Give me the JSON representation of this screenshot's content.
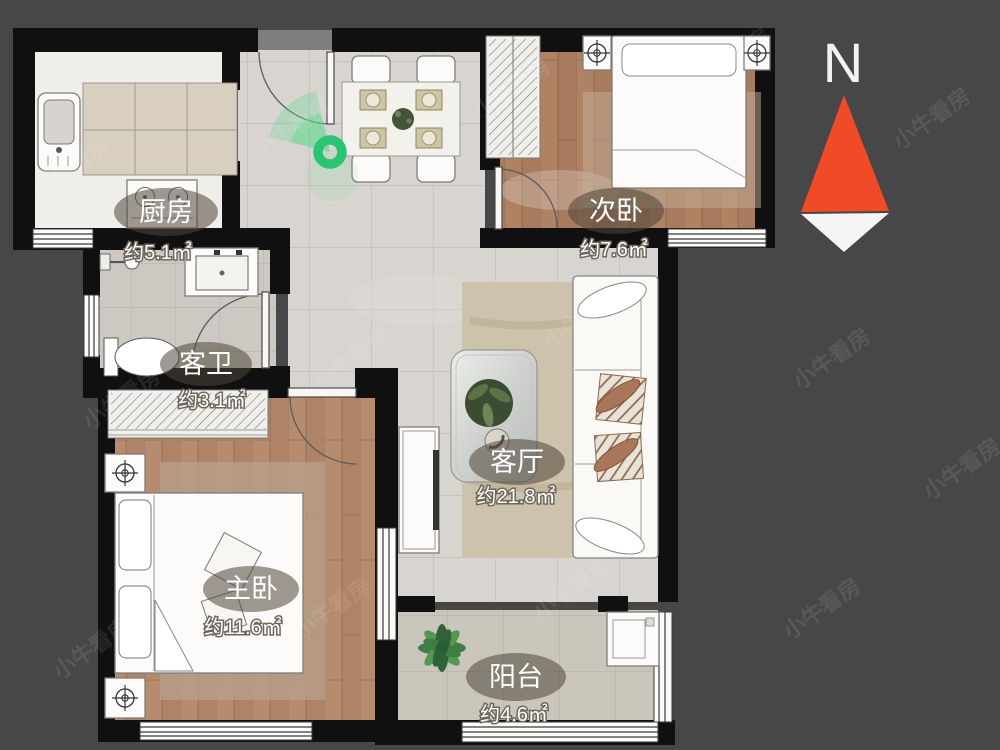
{
  "compass": {
    "label": "N",
    "arrow_color": "#ee4b26"
  },
  "watermark": {
    "text": "小牛看房"
  },
  "marker": {
    "type": "panorama-viewpoint",
    "color": "#2bc472"
  },
  "rooms": [
    {
      "id": "kitchen",
      "name": "厨房",
      "area": "约5.1㎡"
    },
    {
      "id": "second-bedroom",
      "name": "次卧",
      "area": "约7.6㎡"
    },
    {
      "id": "guest-bathroom",
      "name": "客卫",
      "area": "约3.1㎡"
    },
    {
      "id": "living-room",
      "name": "客厅",
      "area": "约21.8㎡"
    },
    {
      "id": "master-bedroom",
      "name": "主卧",
      "area": "约11.6㎡"
    },
    {
      "id": "balcony",
      "name": "阳台",
      "area": "约4.6㎡"
    }
  ]
}
